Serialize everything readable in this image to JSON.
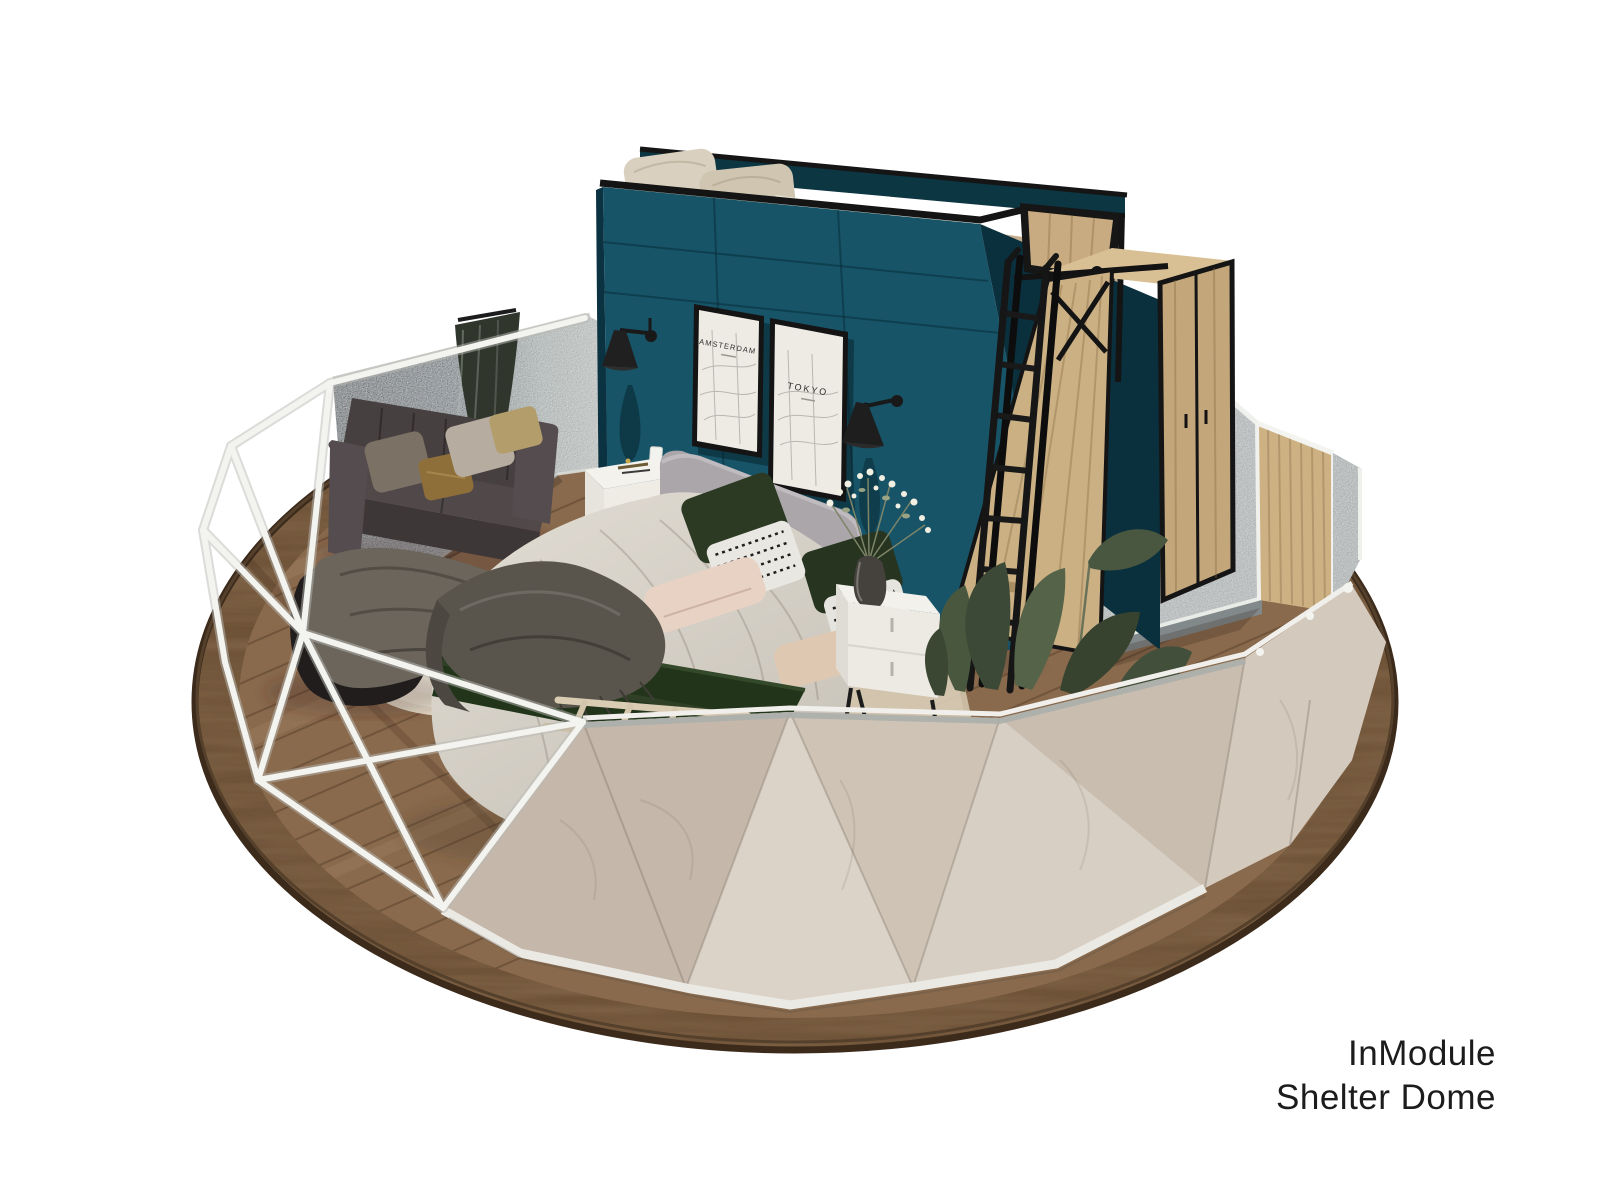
{
  "scene": {
    "caption": {
      "line1": "InModule",
      "line2": "Shelter Dome"
    },
    "posters": {
      "left": {
        "title": "AMSTERDAM"
      },
      "right": {
        "title": "TOKYO"
      }
    },
    "palette": {
      "teal": "#175468",
      "tealShadow": "#0c3642",
      "wood": "#8a6a4e",
      "woodRing": "#6e5237",
      "cover": "#cfc4b8",
      "coverLight": "#dcd3c8",
      "coverDark": "#c5b8ab",
      "frameWhite": "#f3f3ef",
      "fabricGray": "#9ba2a2",
      "fabricDark": "#38444b",
      "oak": "#c4a87c",
      "runnerGreen": "#22351a",
      "plantGreen": "#49573f",
      "caption": "#1c1c1c"
    }
  }
}
